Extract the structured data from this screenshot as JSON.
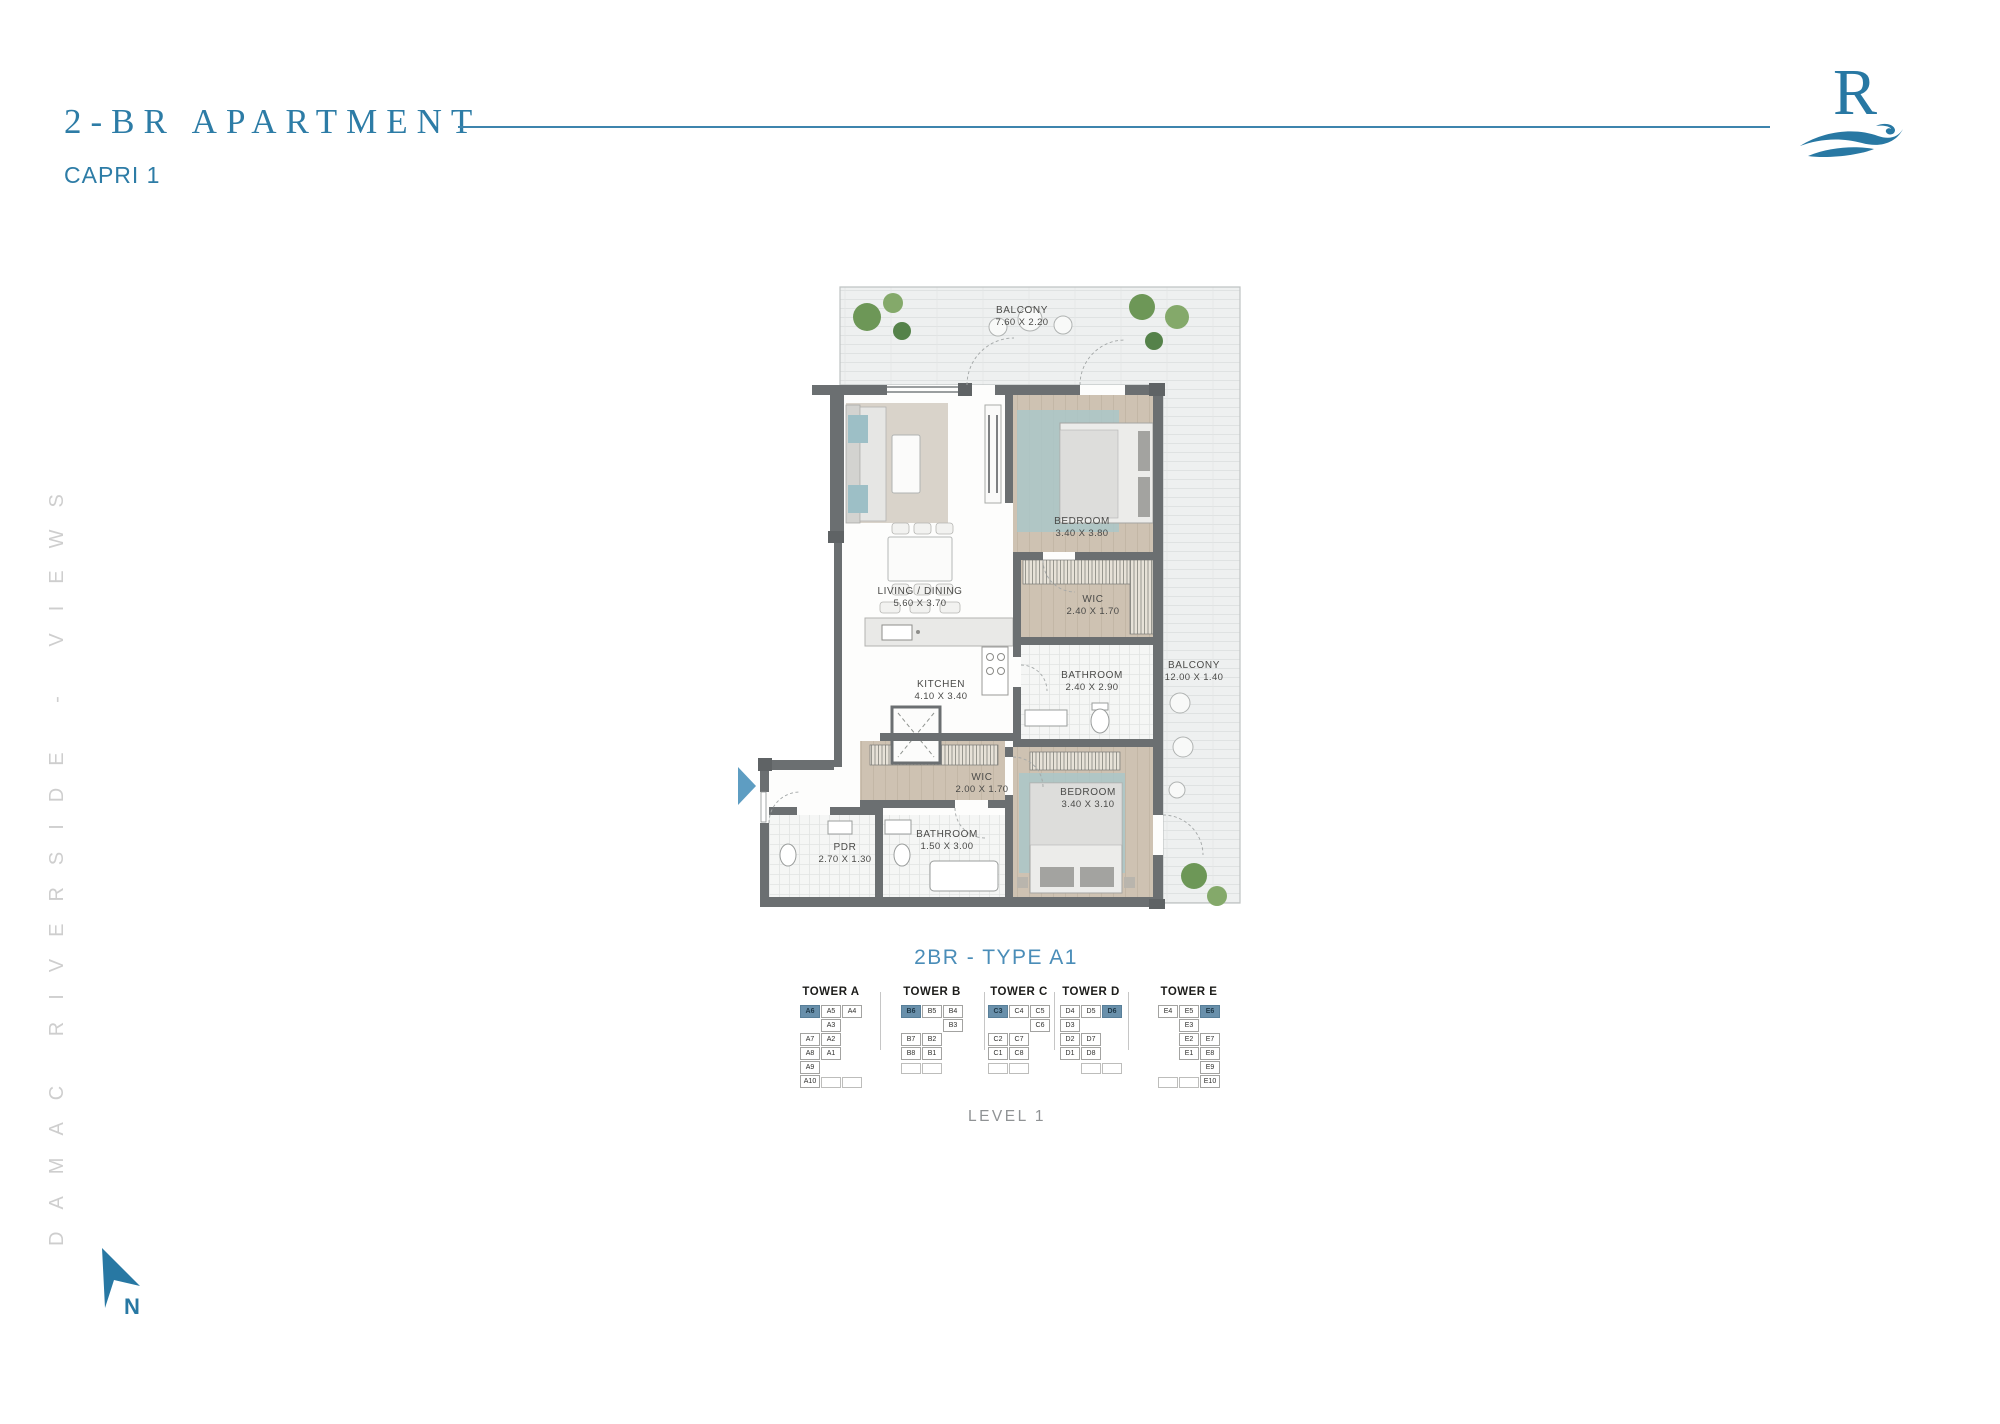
{
  "header": {
    "title": "2-BR APARTMENT",
    "subtitle": "CAPRI 1"
  },
  "logo": {
    "letter": "R"
  },
  "sidebar": {
    "vertical_text": "DAMAC RIVERSIDE - VIEWS"
  },
  "compass": {
    "label": "N"
  },
  "plan": {
    "type_label": "2BR - TYPE A1",
    "level_label": "LEVEL 1",
    "rooms": [
      {
        "name": "BALCONY",
        "dims": "7.60 X 2.20",
        "x": 292,
        "y": 50
      },
      {
        "name": "BEDROOM",
        "dims": "3.40 X 3.80",
        "x": 352,
        "y": 261
      },
      {
        "name": "WIC",
        "dims": "2.40 X 1.70",
        "x": 363,
        "y": 339
      },
      {
        "name": "LIVING / DINING",
        "dims": "5.60 X 3.70",
        "x": 190,
        "y": 331
      },
      {
        "name": "KITCHEN",
        "dims": "4.10 X 3.40",
        "x": 211,
        "y": 424
      },
      {
        "name": "BATHROOM",
        "dims": "2.40 X 2.90",
        "x": 362,
        "y": 415
      },
      {
        "name": "BALCONY",
        "dims": "12.00 X 1.40",
        "x": 464,
        "y": 405
      },
      {
        "name": "WIC",
        "dims": "2.00 X 1.70",
        "x": 252,
        "y": 517
      },
      {
        "name": "BEDROOM",
        "dims": "3.40 X 3.10",
        "x": 358,
        "y": 532
      },
      {
        "name": "PDR",
        "dims": "2.70 X 1.30",
        "x": 115,
        "y": 587
      },
      {
        "name": "BATHROOM",
        "dims": "1.50 X 3.00",
        "x": 217,
        "y": 574
      }
    ]
  },
  "towers": [
    {
      "label": "TOWER A",
      "rows": [
        [
          {
            "t": "A6",
            "h": 1
          },
          {
            "t": "A5"
          },
          {
            "t": "A4"
          }
        ],
        [
          null,
          {
            "t": "A3"
          },
          null
        ],
        [
          {
            "t": "A7"
          },
          {
            "t": "A2"
          },
          null
        ],
        [
          {
            "t": "A8"
          },
          {
            "t": "A1"
          },
          null
        ],
        [
          {
            "t": "A9"
          },
          null,
          null
        ],
        [
          {
            "t": "A10"
          },
          {
            "s": 1
          },
          {
            "s": 1
          }
        ]
      ]
    },
    {
      "label": "TOWER B",
      "rows": [
        [
          {
            "t": "B6",
            "h": 1
          },
          {
            "t": "B5"
          },
          {
            "t": "B4"
          }
        ],
        [
          null,
          null,
          {
            "t": "B3"
          }
        ],
        [
          {
            "t": "B7"
          },
          {
            "t": "B2"
          },
          null
        ],
        [
          {
            "t": "B8"
          },
          {
            "t": "B1"
          },
          null
        ],
        [
          {
            "s": 1
          },
          {
            "s": 1
          },
          null
        ]
      ]
    },
    {
      "label": "TOWER C",
      "rows": [
        [
          {
            "t": "C3",
            "h": 1
          },
          {
            "t": "C4"
          },
          {
            "t": "C5"
          }
        ],
        [
          null,
          null,
          {
            "t": "C6"
          }
        ],
        [
          {
            "t": "C2"
          },
          {
            "t": "C7"
          },
          null
        ],
        [
          {
            "t": "C1"
          },
          {
            "t": "C8"
          },
          null
        ],
        [
          {
            "s": 1
          },
          {
            "s": 1
          },
          null
        ]
      ]
    },
    {
      "label": "TOWER D",
      "rows": [
        [
          {
            "t": "D4"
          },
          {
            "t": "D5"
          },
          {
            "t": "D6",
            "h": 1
          }
        ],
        [
          {
            "t": "D3"
          },
          null,
          null
        ],
        [
          {
            "t": "D2"
          },
          {
            "t": "D7"
          },
          null
        ],
        [
          {
            "t": "D1"
          },
          {
            "t": "D8"
          },
          null
        ],
        [
          null,
          {
            "s": 1
          },
          {
            "s": 1
          }
        ]
      ]
    },
    {
      "label": "TOWER E",
      "rows": [
        [
          {
            "t": "E4"
          },
          {
            "t": "E5"
          },
          {
            "t": "E6",
            "h": 1
          }
        ],
        [
          null,
          {
            "t": "E3"
          },
          null
        ],
        [
          null,
          {
            "t": "E2"
          },
          {
            "t": "E7"
          }
        ],
        [
          null,
          {
            "t": "E1"
          },
          {
            "t": "E8"
          }
        ],
        [
          null,
          null,
          {
            "t": "E9"
          }
        ],
        [
          {
            "s": 1
          },
          {
            "s": 1
          },
          {
            "t": "E10"
          }
        ]
      ]
    }
  ],
  "colors": {
    "accent": "#2d7ca6",
    "type_blue": "#4a8db8",
    "wall": "#6b6f71",
    "highlight_cell": "#6990ab",
    "wood_floor": "#cec2b2",
    "rug_teal": "#aac7c8",
    "balcony_tile": "#eef0f0"
  }
}
